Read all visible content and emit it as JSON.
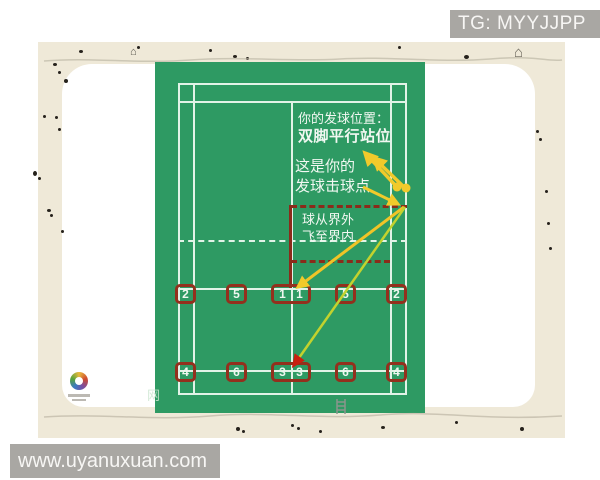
{
  "header": {
    "tg_label": "TG: MYYJJPP"
  },
  "footer": {
    "url": "www.uyanuxuan.com"
  },
  "annotations": {
    "serve_position_line1": "你的发球位置：",
    "serve_position_line2": "双脚平行站位",
    "hit_point_line1": "这是你的",
    "hit_point_line2": "发球击球点",
    "trajectory_line1": "球从界外",
    "trajectory_line2": "飞至界内",
    "net_watermark": "网"
  },
  "court": {
    "row1": [
      "2",
      "5",
      "1",
      "1",
      "5",
      "2"
    ],
    "row2": [
      "4",
      "6",
      "3",
      "3",
      "6",
      "4"
    ]
  },
  "icons": {
    "house_glyph": "⌂"
  },
  "colors": {
    "court_green": "#2e9a63",
    "court_line_white": "#e2f3e7",
    "maroon": "#93301d",
    "arrow_yellow": "#f1ca2b",
    "arrow_yellow_green": "#c3d22e",
    "arrowhead_red": "#c81f10",
    "beige_bg": "#efe9d8",
    "watermark_gray": "#a9a7a3"
  }
}
